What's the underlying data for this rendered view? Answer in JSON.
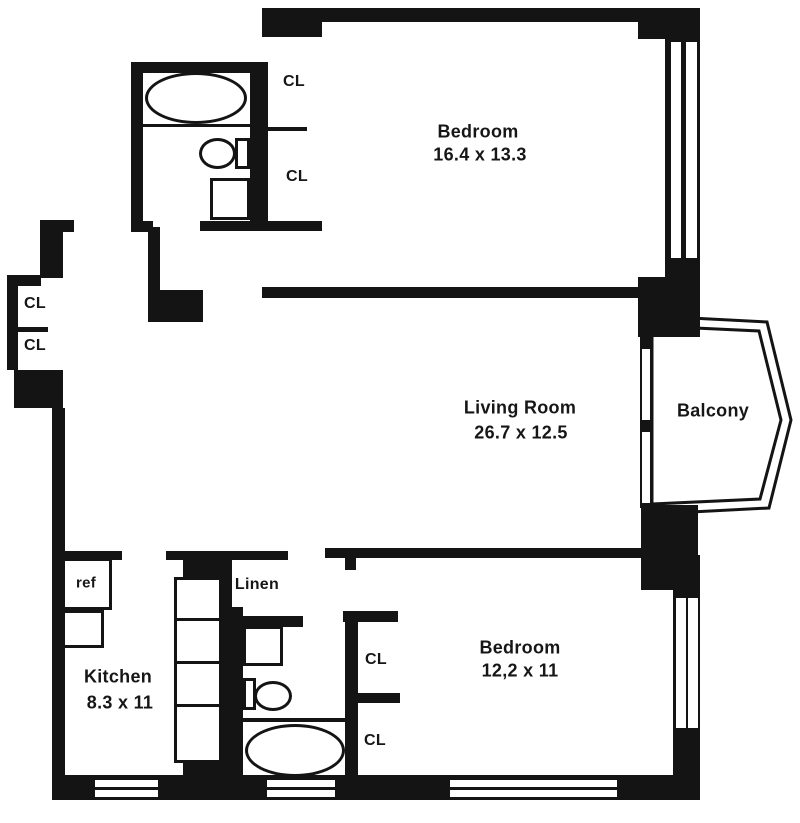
{
  "colors": {
    "wall": "#141414",
    "background": "#ffffff",
    "text": "#161616"
  },
  "rooms": {
    "bedroom_top": {
      "name": "Bedroom",
      "dims": "16.4 x 13.3"
    },
    "living_room": {
      "name": "Living Room",
      "dims": "26.7 x 12.5"
    },
    "balcony": {
      "name": "Balcony"
    },
    "kitchen": {
      "name": "Kitchen",
      "dims": "8.3 x 11"
    },
    "bedroom_bottom": {
      "name": "Bedroom",
      "dims": "12,2 x 11"
    },
    "linen_closet": {
      "name": "Linen"
    }
  },
  "labels": {
    "refrigerator": "ref"
  },
  "closets": {
    "bath_hall_upper": "CL",
    "bath_hall_lower": "CL",
    "entry_upper": "CL",
    "entry_lower": "CL",
    "bedroom_bottom_upper": "CL",
    "bedroom_bottom_lower": "CL"
  },
  "fixtures": {
    "bathroom_top": [
      "bathtub",
      "toilet",
      "sink"
    ],
    "bathroom_bottom": [
      "sink",
      "toilet",
      "bathtub"
    ],
    "kitchen": [
      "refrigerator",
      "counter",
      "pantry-shelves"
    ]
  }
}
